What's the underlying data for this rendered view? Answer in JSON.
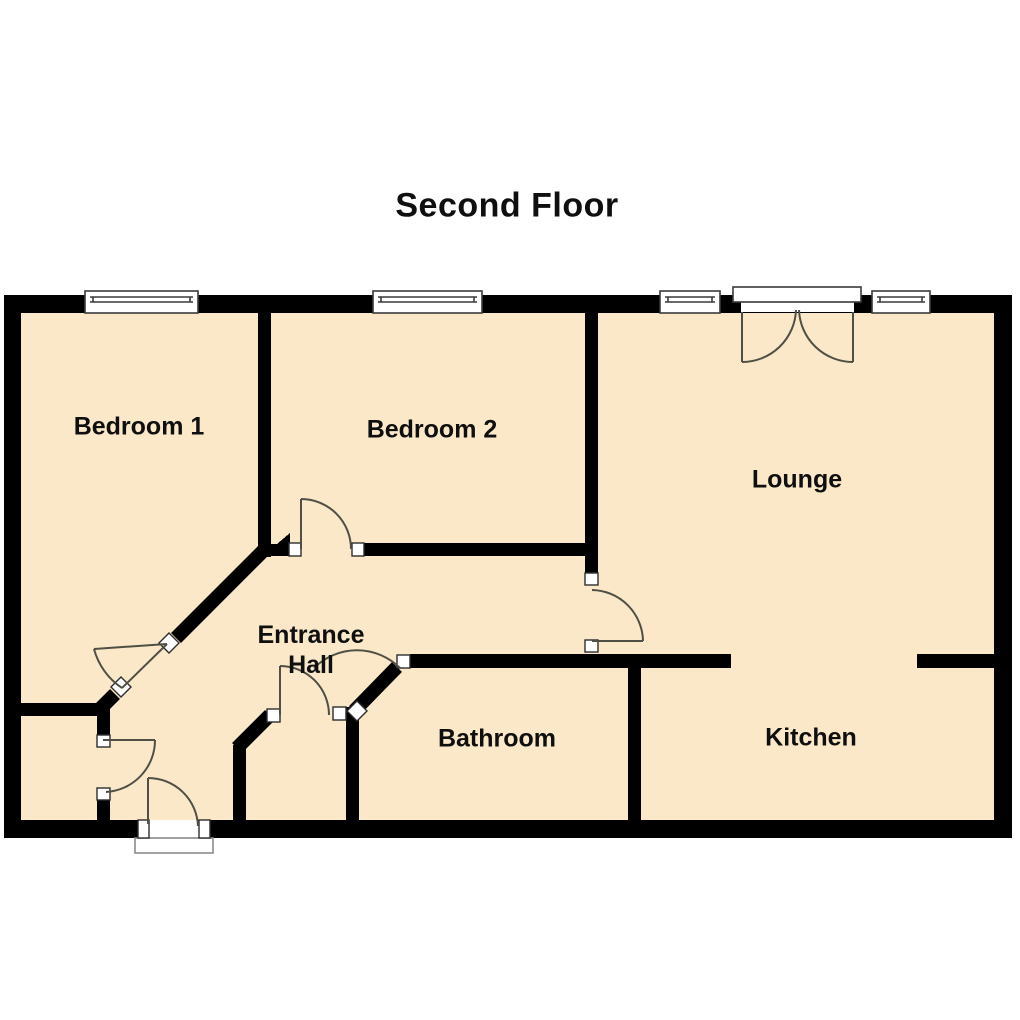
{
  "title": "Second Floor",
  "rooms": {
    "bedroom1": {
      "label": "Bedroom 1"
    },
    "bedroom2": {
      "label": "Bedroom 2"
    },
    "lounge": {
      "label": "Lounge"
    },
    "entrance_hall": {
      "line1": "Entrance",
      "line2": "Hall"
    },
    "bathroom": {
      "label": "Bathroom"
    },
    "kitchen": {
      "label": "Kitchen"
    }
  },
  "symbols": {
    "windows": [
      "bedroom1-window",
      "bedroom2-window",
      "lounge-window-left",
      "lounge-window-right"
    ],
    "doors": [
      "french-doors",
      "entrance-front-door",
      "bedroom1-door",
      "bedroom2-door",
      "lounge-door",
      "bathroom-door",
      "cupboard-door",
      "store-room-door"
    ]
  },
  "colors": {
    "background": "#FFFFFF",
    "floor": "#FAE8C8",
    "wall": "#000000",
    "door_arc": "#4F4F45",
    "window_outline": "#3A3A3A",
    "cap_outline": "#2E2E2E",
    "threshold_outline": "#8A8A8A",
    "text": "#0F0F0F"
  }
}
